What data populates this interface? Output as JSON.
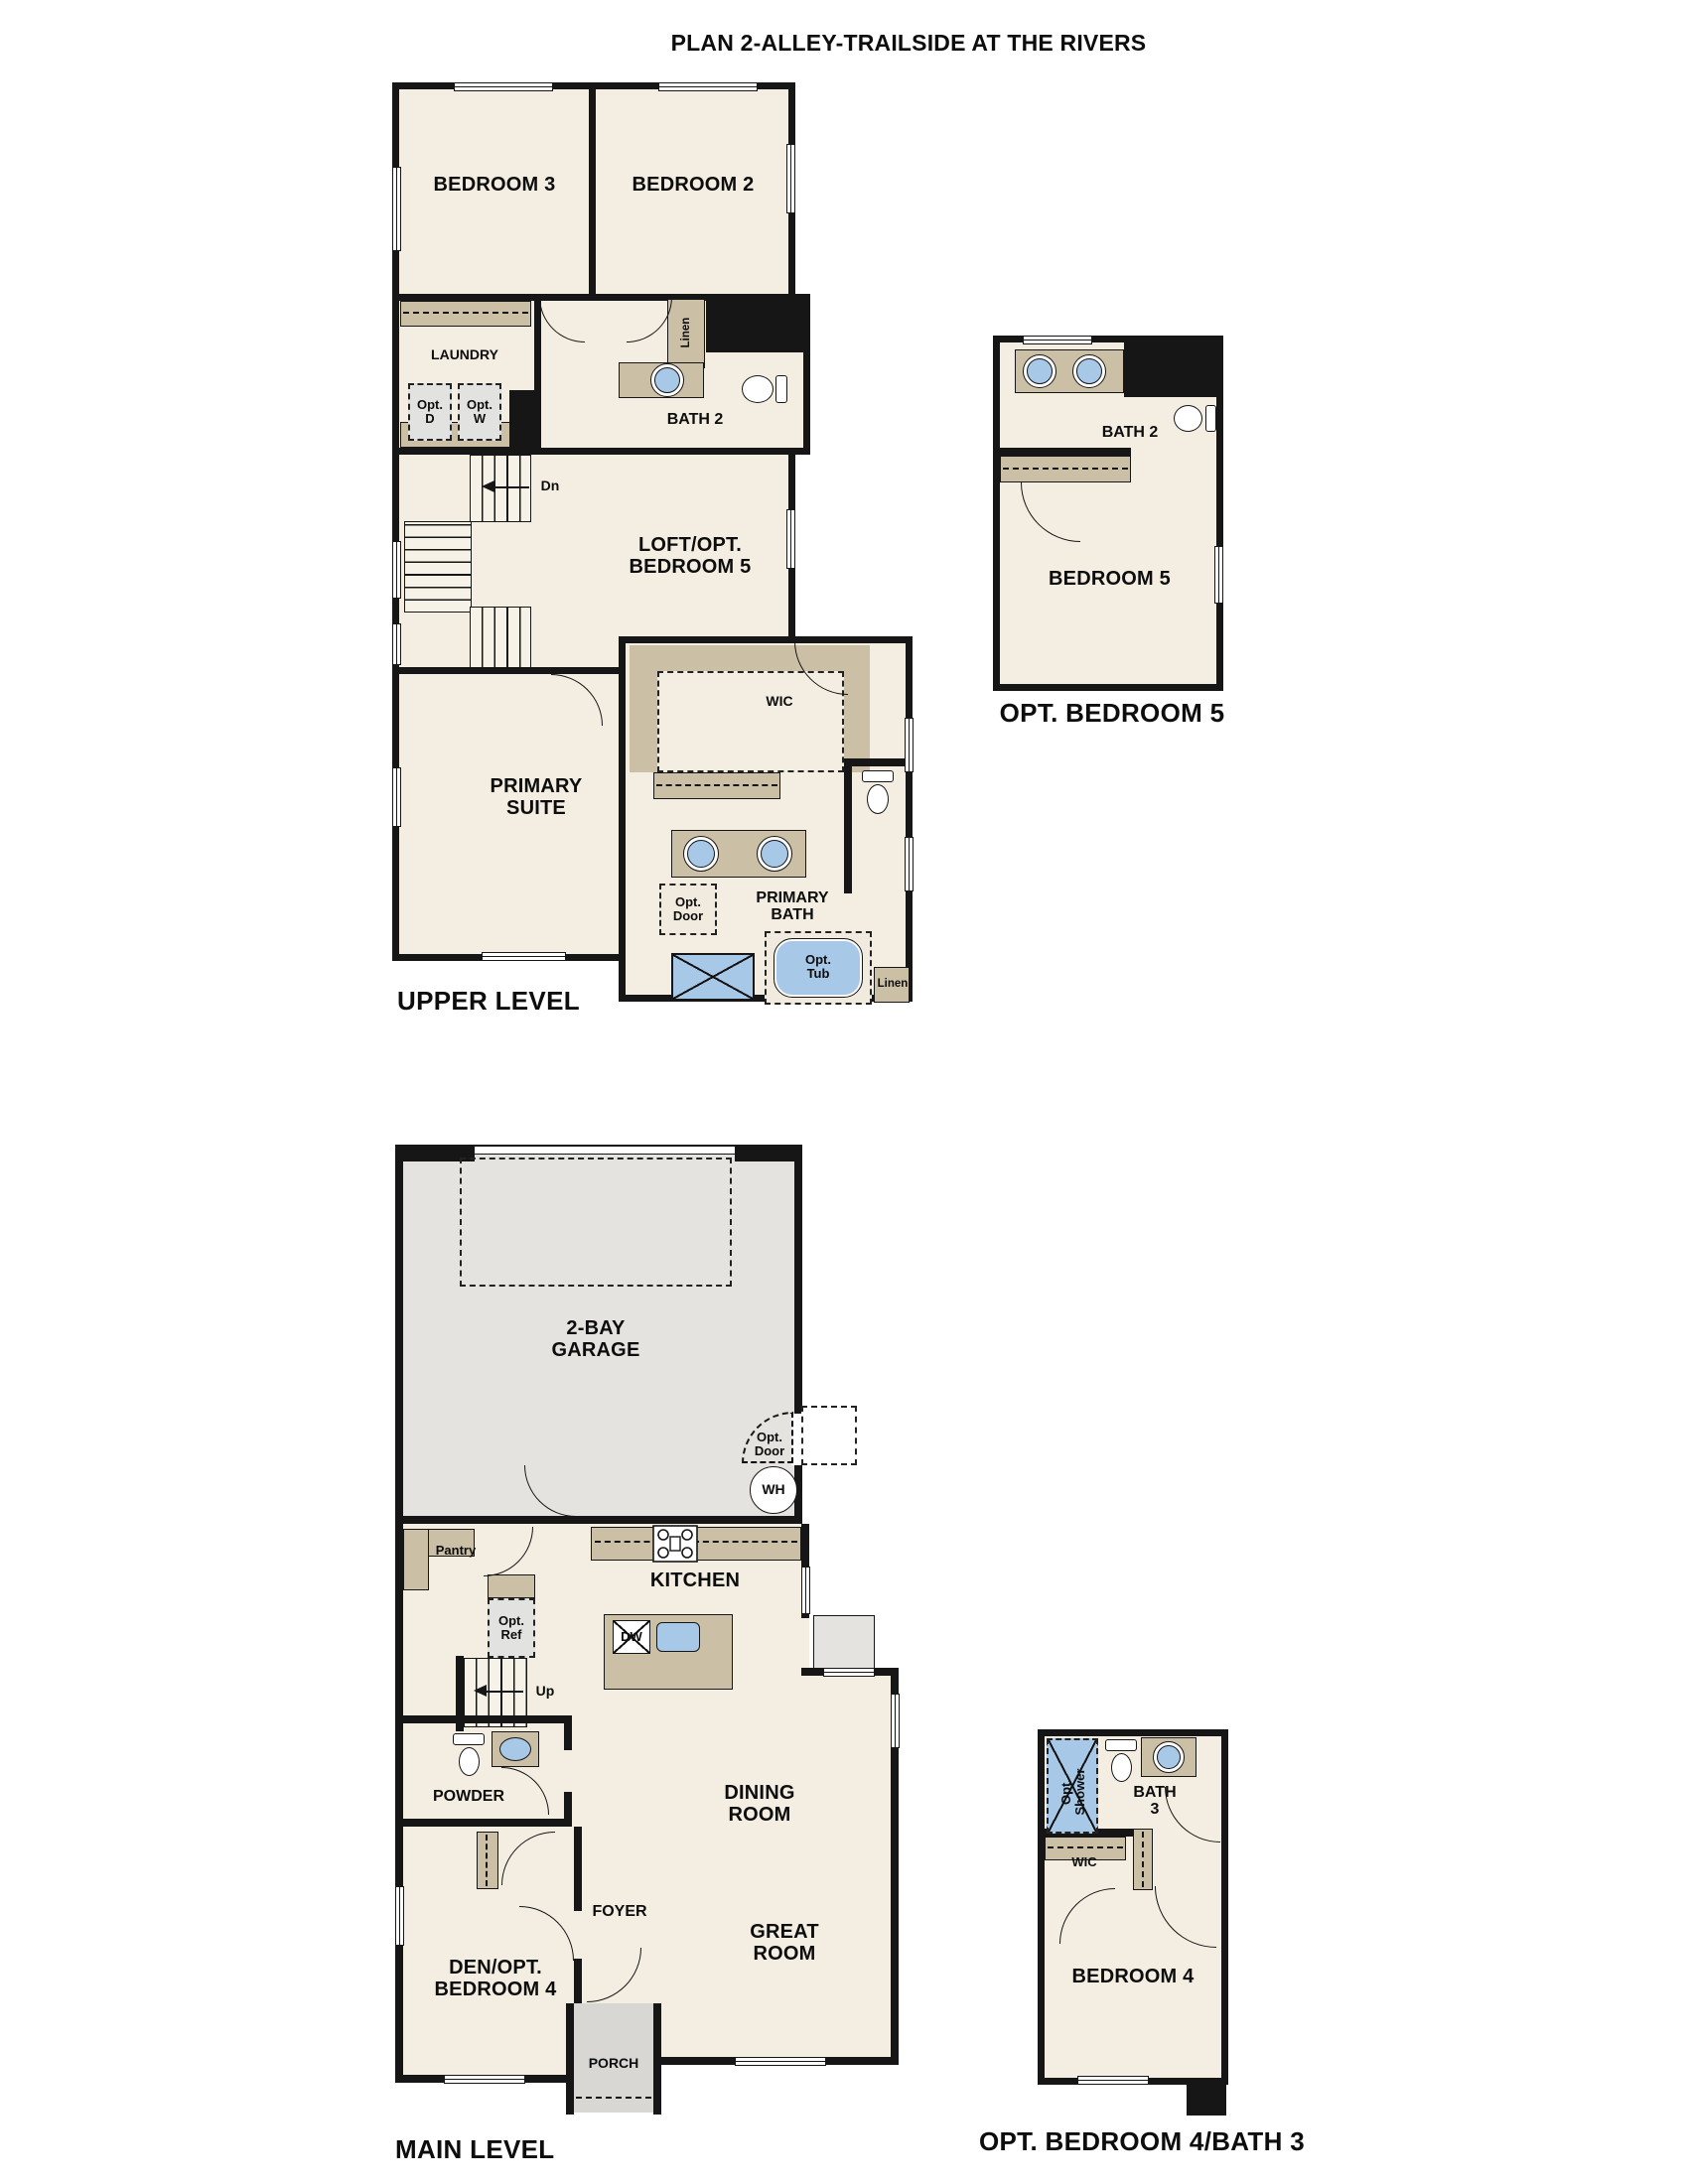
{
  "title": "PLAN 2-ALLEY-TRAILSIDE AT THE RIVERS",
  "colors": {
    "wall": "#161616",
    "room_fill": "#f4eee2",
    "counter_tan": "#cbbfa5",
    "fixture_blue": "#a8c8e8",
    "garage_gray": "#e5e3df",
    "porch_gray": "#d8d7d3"
  },
  "plans": {
    "upper_level": {
      "caption": "UPPER LEVEL",
      "labels": {
        "bedroom3": "BEDROOM 3",
        "bedroom2": "BEDROOM 2",
        "laundry": "LAUNDRY",
        "opt_dryer": "Opt.\nD",
        "opt_washer": "Opt.\nW",
        "linen_hall": "Linen",
        "bath2": "BATH 2",
        "stairs_down": "Dn",
        "loft": "LOFT/OPT.\nBEDROOM 5",
        "primary_suite": "PRIMARY\nSUITE",
        "wic": "WIC",
        "primary_bath": "PRIMARY\nBATH",
        "opt_door": "Opt.\nDoor",
        "opt_tub": "Opt.\nTub",
        "linen_bath": "Linen"
      }
    },
    "opt_bedroom5": {
      "caption": "OPT. BEDROOM 5",
      "labels": {
        "bath2": "BATH 2",
        "bedroom5": "BEDROOM 5"
      }
    },
    "main_level": {
      "caption": "MAIN LEVEL",
      "labels": {
        "garage": "2-BAY\nGARAGE",
        "opt_door": "Opt.\nDoor",
        "water_heater": "WH",
        "pantry": "Pantry",
        "kitchen": "KITCHEN",
        "dishwasher": "DW",
        "opt_fridge": "Opt.\nRef",
        "stairs_up": "Up",
        "powder": "POWDER",
        "dining_room": "DINING\nROOM",
        "great_room": "GREAT\nROOM",
        "foyer": "FOYER",
        "den": "DEN/OPT.\nBEDROOM 4",
        "porch": "PORCH"
      }
    },
    "opt_bedroom4_bath3": {
      "caption": "OPT. BEDROOM 4/BATH 3",
      "labels": {
        "opt_shower": "Opt.\nShower",
        "bath3": "BATH\n3",
        "wic": "WIC",
        "bedroom4": "BEDROOM 4"
      }
    }
  }
}
